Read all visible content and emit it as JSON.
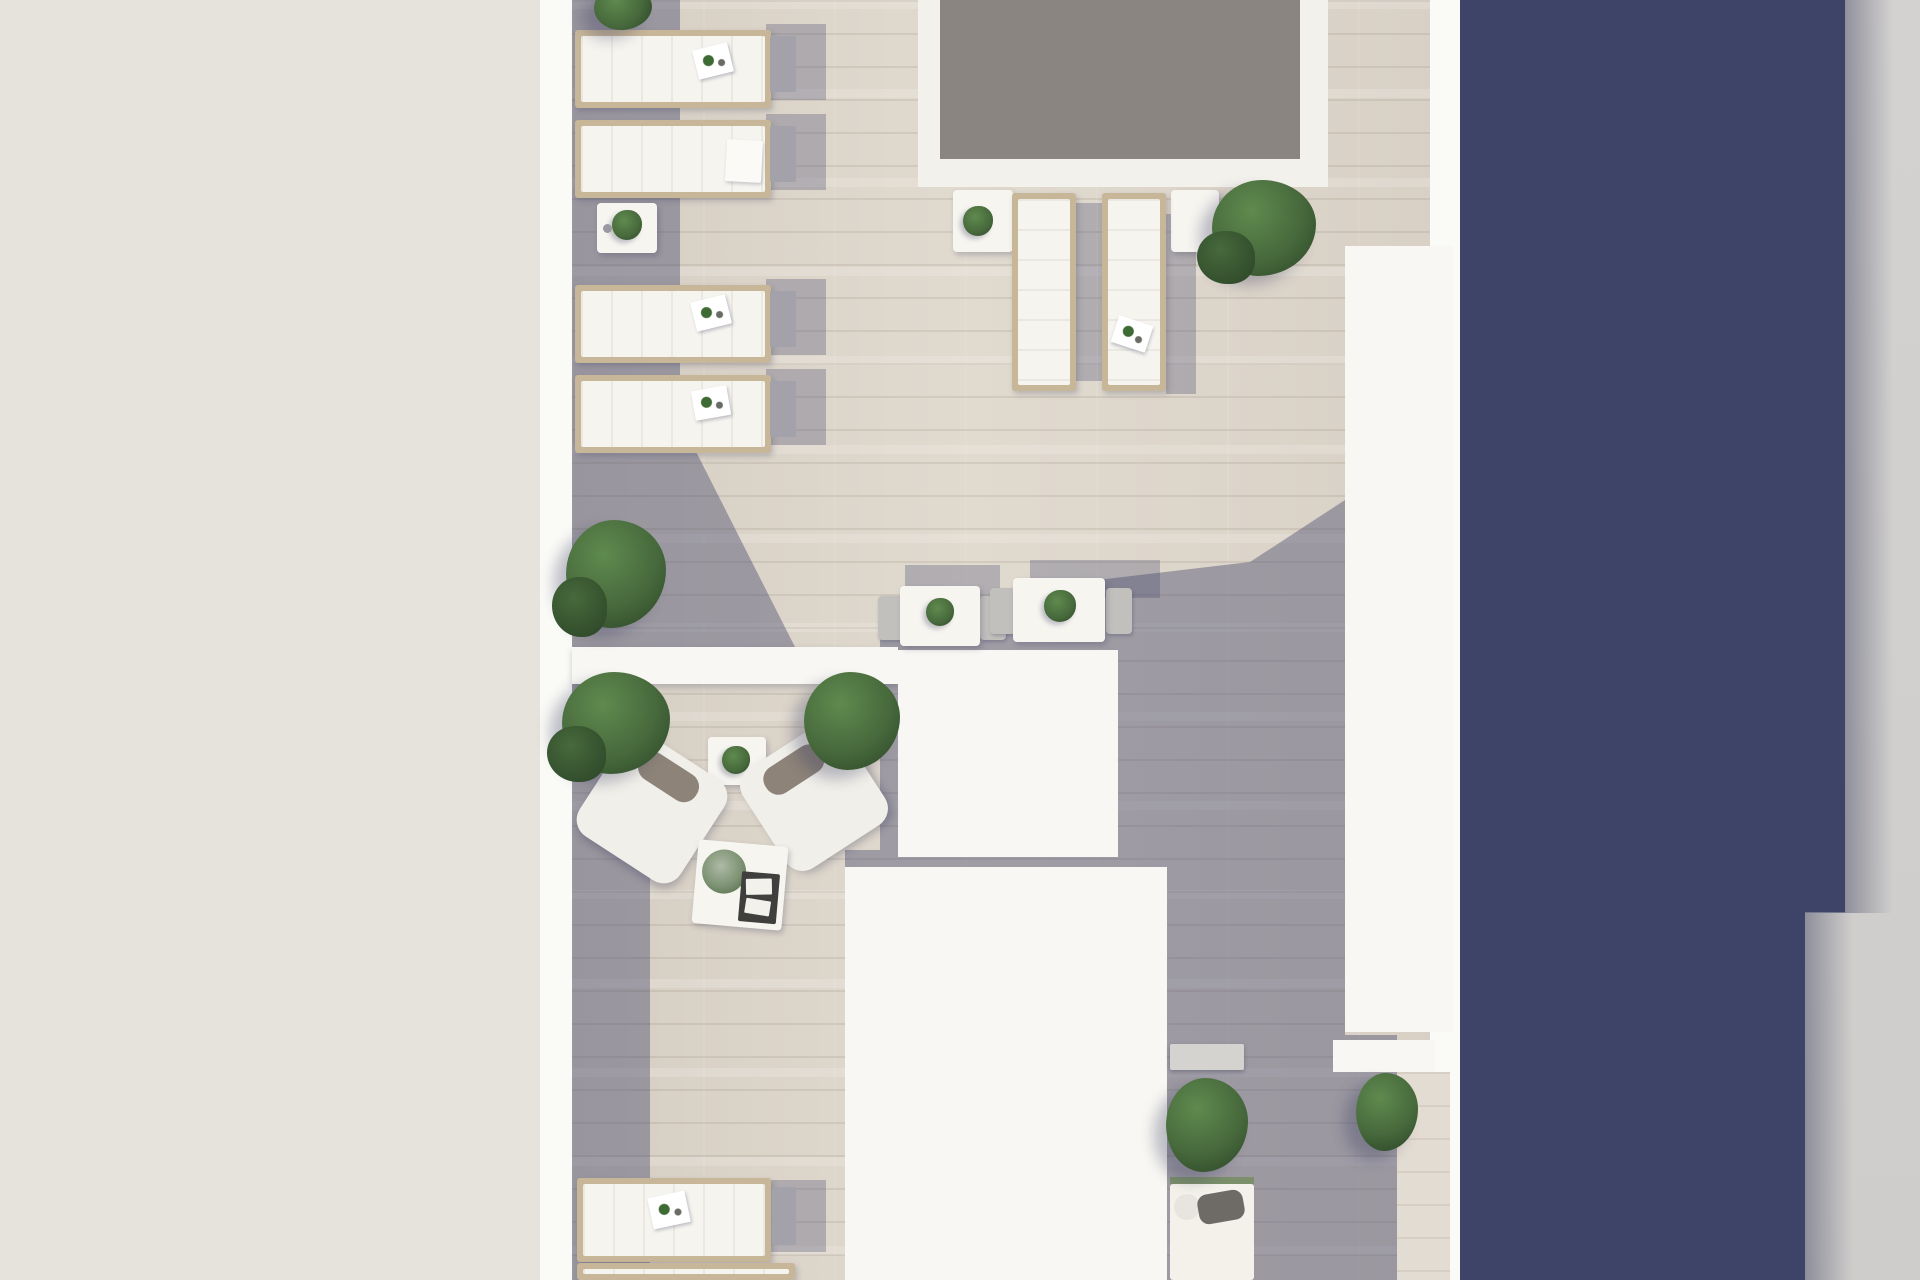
{
  "scene": {
    "description": "Top-down architectural 3D rendering of a rooftop terrace: a grey-water pool with white deck at top, rows of white sun loungers with side tables along the left parapet, two loungers below the pool, two bistro table sets, a lounge corner with two armchairs and a coffee table, white rooftop volumes, planters and bushes, a bottom-right daybed, all beside a dark navy building face with a light grey wall band at the far right.",
    "palette": {
      "beige_surround": "#e6e3dd",
      "parapet_white": "#fafaf7",
      "structure_white": "#f8f7f3",
      "floor_sun": "#dbd3c8",
      "floor_sun_light": "#e3dcd2",
      "floor_shadow_tint": "rgba(70,72,108,0.42)",
      "pool_water": "#8a8581",
      "pool_deck": "#f3f1ec",
      "navy_facade": "#3d4468",
      "right_wall_grey": "#d2d0ce",
      "lounger_frame": "#c8b698",
      "lounger_cushion": "#f6f4ef",
      "side_table_grey": "#a3a1a9",
      "bistro_chair_grey": "#c2c0bd",
      "armchair_white": "#f1efe9",
      "armchair_cushion": "#8d8379",
      "tray_dark": "#3f3f3d",
      "daybed_cushion": "#6e6b66",
      "planter_bench": "#d5d3cf",
      "plant_dark": "#2f4a2a",
      "plant_mid": "#47693c",
      "plant_light": "#5f8a4e"
    },
    "objects": [
      {
        "name": "swimming-pool",
        "count": 1,
        "note": "grey water, white deck border, top centre"
      },
      {
        "name": "sun-lounger-row-left",
        "count": 4,
        "note": "horizontal white loungers with tan frames and grey side tables along left parapet"
      },
      {
        "name": "pool-side-lounger",
        "count": 2,
        "note": "vertical loungers below pool deck with white side tables"
      },
      {
        "name": "bottom-lounger",
        "count": 2,
        "note": "bottom-left, one partially cropped"
      },
      {
        "name": "bistro-table-set",
        "count": 2,
        "note": "white tables with plants and grey chairs at shadow edge"
      },
      {
        "name": "armchair",
        "count": 2,
        "note": "rotated white lounge chairs with grey cushions"
      },
      {
        "name": "coffee-table",
        "count": 1,
        "note": "white table with plant and dark magazine tray"
      },
      {
        "name": "side-table-with-plant",
        "count": 3,
        "note": "small white tables holding green plants"
      },
      {
        "name": "bush",
        "count": 7,
        "note": "green shrubs around terrace"
      },
      {
        "name": "rooftop-volume",
        "count": 3,
        "note": "large white roof structures"
      },
      {
        "name": "planter-bench",
        "count": 1,
        "note": "bottom right grey bench"
      },
      {
        "name": "daybed",
        "count": 1,
        "note": "bottom right white daybed with dark cushion"
      }
    ]
  }
}
